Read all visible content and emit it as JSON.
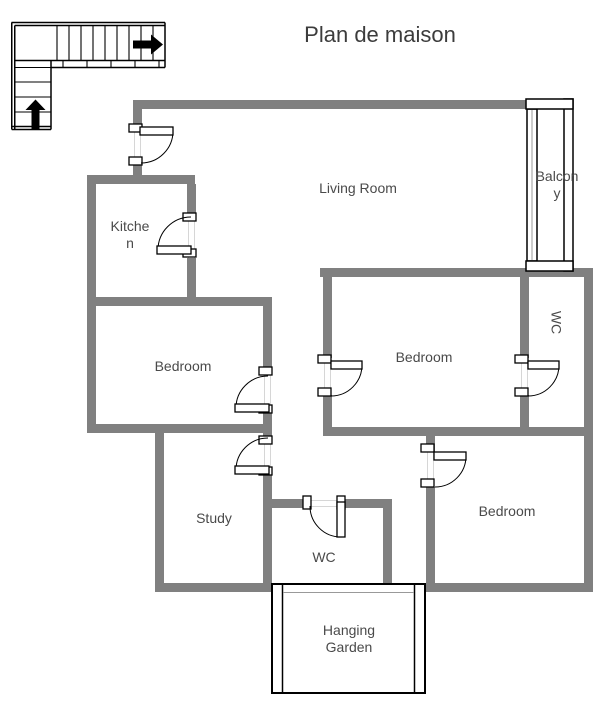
{
  "title": "Plan de maison",
  "rooms": {
    "kitchen": {
      "label": "Kitchen"
    },
    "living_room": {
      "label": "Living Room"
    },
    "balcony": {
      "label": "Balcony"
    },
    "bedroom_left": {
      "label": "Bedroom"
    },
    "bedroom_middle": {
      "label": "Bedroom"
    },
    "wc_upper": {
      "label": "WC"
    },
    "study": {
      "label": "Study"
    },
    "wc_lower": {
      "label": "WC"
    },
    "bedroom_right": {
      "label": "Bedroom"
    },
    "hanging_garden": {
      "label": "Hanging Garden"
    }
  },
  "icons": {
    "staircase": "staircase-icon",
    "up_arrow": "up-arrow-icon",
    "right_arrow": "right-arrow-icon",
    "door": "door-swing-icon"
  },
  "colors": {
    "wall": "#808080",
    "outline": "#000000",
    "label": "#4a4a4a",
    "guide": "#d6d6d6",
    "window": "#999999"
  }
}
